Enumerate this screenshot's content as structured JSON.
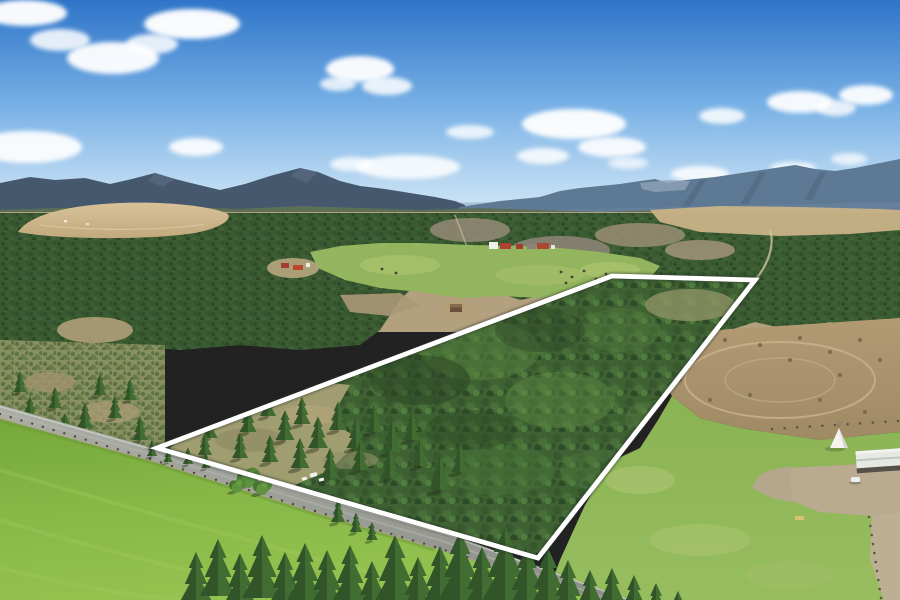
{
  "meta": {
    "title": "aerial-property-photo-with-boundary-overlay",
    "width": 900,
    "height": 600
  },
  "palette": {
    "sky_top": "#2e74c8",
    "sky_mid": "#7ab2e6",
    "sky_horizon": "#ddecf8",
    "cloud": "#ffffff",
    "mountain_haze": "#a9bdd1",
    "mountain_left": "#46586e",
    "mountain_right": "#5e7994",
    "mountain_cliff": "#8ea3b6",
    "foothill": "#5d7056",
    "valley_scrub": "#a5947a",
    "tan_field": "#d0ba8f",
    "forest_dark": "#2c4826",
    "forest_mid": "#3f6134",
    "forest_light": "#55823d",
    "pasture_center": "#93b55e",
    "pasture_left_top": "#75a83a",
    "pasture_left_bottom": "#94c24f",
    "pasture_right": "#8fb657",
    "dirt_field": "#ab9570",
    "gravel": "#b9aa90",
    "road": "#9ea29a",
    "road_fog_line": "#d8d9d4",
    "boundary": "#ffffff",
    "barn_red": "#b04232",
    "roof_white": "#e6e8e4",
    "teepee_white": "#f4f3ef"
  },
  "boundary": {
    "points": [
      [
        157,
        448
      ],
      [
        612,
        276
      ],
      [
        755,
        280
      ],
      [
        538,
        558
      ]
    ],
    "stroke_width": 4.8
  },
  "clouds": [
    [
      25,
      13,
      42,
      13,
      0.96
    ],
    [
      60,
      40,
      30,
      11,
      0.85
    ],
    [
      192,
      24,
      48,
      15,
      0.97
    ],
    [
      113,
      58,
      46,
      16,
      0.95
    ],
    [
      152,
      44,
      26,
      10,
      0.85
    ],
    [
      28,
      147,
      54,
      16,
      0.93
    ],
    [
      196,
      147,
      27,
      9,
      0.9
    ],
    [
      360,
      69,
      34,
      13,
      0.95
    ],
    [
      387,
      86,
      25,
      9,
      0.85
    ],
    [
      338,
      84,
      18,
      7,
      0.8
    ],
    [
      470,
      132,
      24,
      7,
      0.8
    ],
    [
      574,
      124,
      52,
      15,
      0.95
    ],
    [
      612,
      147,
      34,
      10,
      0.9
    ],
    [
      543,
      156,
      26,
      8,
      0.85
    ],
    [
      408,
      167,
      52,
      12,
      0.85
    ],
    [
      352,
      164,
      22,
      7,
      0.78
    ],
    [
      722,
      116,
      23,
      8,
      0.85
    ],
    [
      800,
      102,
      33,
      11,
      0.93
    ],
    [
      866,
      95,
      27,
      10,
      0.93
    ],
    [
      836,
      108,
      20,
      8,
      0.8
    ],
    [
      700,
      174,
      29,
      8,
      0.85
    ],
    [
      793,
      168,
      23,
      6,
      0.8
    ],
    [
      849,
      159,
      18,
      6,
      0.72
    ],
    [
      628,
      163,
      20,
      6,
      0.7
    ]
  ],
  "parcel_trees": [
    [
      210,
      438,
      0.8
    ],
    [
      228,
      420,
      0.85
    ],
    [
      248,
      432,
      0.9
    ],
    [
      268,
      416,
      0.85
    ],
    [
      285,
      440,
      1.0
    ],
    [
      302,
      424,
      0.9
    ],
    [
      318,
      448,
      1.05
    ],
    [
      338,
      430,
      0.95
    ],
    [
      356,
      448,
      1.0
    ],
    [
      374,
      432,
      0.9
    ],
    [
      392,
      452,
      1.05
    ],
    [
      412,
      440,
      0.95
    ],
    [
      300,
      468,
      1.0
    ],
    [
      270,
      462,
      0.9
    ],
    [
      240,
      458,
      0.85
    ],
    [
      205,
      455,
      0.75
    ],
    [
      330,
      478,
      1.0
    ],
    [
      360,
      470,
      0.95
    ],
    [
      390,
      478,
      1.0
    ],
    [
      420,
      466,
      0.9
    ],
    [
      440,
      490,
      1.1
    ],
    [
      460,
      472,
      0.95
    ]
  ],
  "north_scrub_trees": [
    [
      30,
      420,
      0.8
    ],
    [
      55,
      408,
      0.7
    ],
    [
      85,
      428,
      0.85
    ],
    [
      115,
      418,
      0.75
    ],
    [
      140,
      440,
      0.8
    ],
    [
      65,
      440,
      0.9
    ],
    [
      20,
      392,
      0.7
    ],
    [
      100,
      395,
      0.7
    ],
    [
      130,
      400,
      0.7
    ]
  ],
  "roadside_conifers": [
    [
      152,
      456,
      0.55
    ],
    [
      168,
      462,
      0.5
    ],
    [
      188,
      464,
      0.55
    ],
    [
      206,
      468,
      0.5
    ],
    [
      338,
      522,
      0.75
    ],
    [
      356,
      532,
      0.65
    ],
    [
      372,
      540,
      0.6
    ]
  ],
  "roadside_round_trees": [
    [
      248,
      484,
      1.1
    ],
    [
      262,
      492,
      0.9
    ],
    [
      237,
      490,
      0.8
    ]
  ],
  "foreground_trees": [
    [
      196,
      600,
      1.6
    ],
    [
      218,
      596,
      1.9
    ],
    [
      240,
      604,
      1.7
    ],
    [
      262,
      598,
      2.1
    ],
    [
      285,
      606,
      1.8
    ],
    [
      305,
      600,
      1.9
    ],
    [
      327,
      610,
      2.0
    ],
    [
      350,
      602,
      1.9
    ],
    [
      372,
      612,
      1.7
    ],
    [
      395,
      604,
      2.3
    ],
    [
      418,
      614,
      1.9
    ],
    [
      440,
      606,
      2.0
    ],
    [
      460,
      600,
      2.3
    ],
    [
      482,
      610,
      2.1
    ],
    [
      505,
      602,
      2.5
    ],
    [
      527,
      612,
      2.2
    ],
    [
      548,
      608,
      2.0
    ],
    [
      568,
      614,
      1.8
    ],
    [
      590,
      618,
      1.6
    ],
    [
      612,
      616,
      1.6
    ],
    [
      634,
      620,
      1.5
    ],
    [
      656,
      622,
      1.3
    ],
    [
      678,
      624,
      1.1
    ]
  ],
  "livestock_dots": [
    [
      561,
      272
    ],
    [
      572,
      277
    ],
    [
      584,
      271
    ],
    [
      596,
      279
    ],
    [
      566,
      283
    ],
    [
      606,
      274
    ],
    [
      591,
      284
    ],
    [
      382,
      269
    ],
    [
      396,
      273
    ]
  ],
  "guardrail_line": {
    "points": [
      [
        0,
        414
      ],
      [
        150,
        459
      ],
      [
        315,
        511
      ],
      [
        435,
        547
      ],
      [
        597,
        598
      ]
    ],
    "gap": 11
  },
  "top_fence_line": {
    "points": [
      [
        772,
        429
      ],
      [
        898,
        421
      ]
    ],
    "gap": 12
  },
  "driveway_fence_line": {
    "points": [
      [
        869,
        517
      ],
      [
        881,
        598
      ]
    ],
    "gap": 9
  },
  "landmarks": {
    "teepee": {
      "x": 839,
      "y": 448
    },
    "barn": {
      "x": 856,
      "y": 450
    },
    "car": {
      "x": 851,
      "y": 477
    },
    "white_rv_specks": [
      [
        313,
        475
      ],
      [
        322,
        480
      ],
      [
        305,
        479
      ]
    ]
  }
}
